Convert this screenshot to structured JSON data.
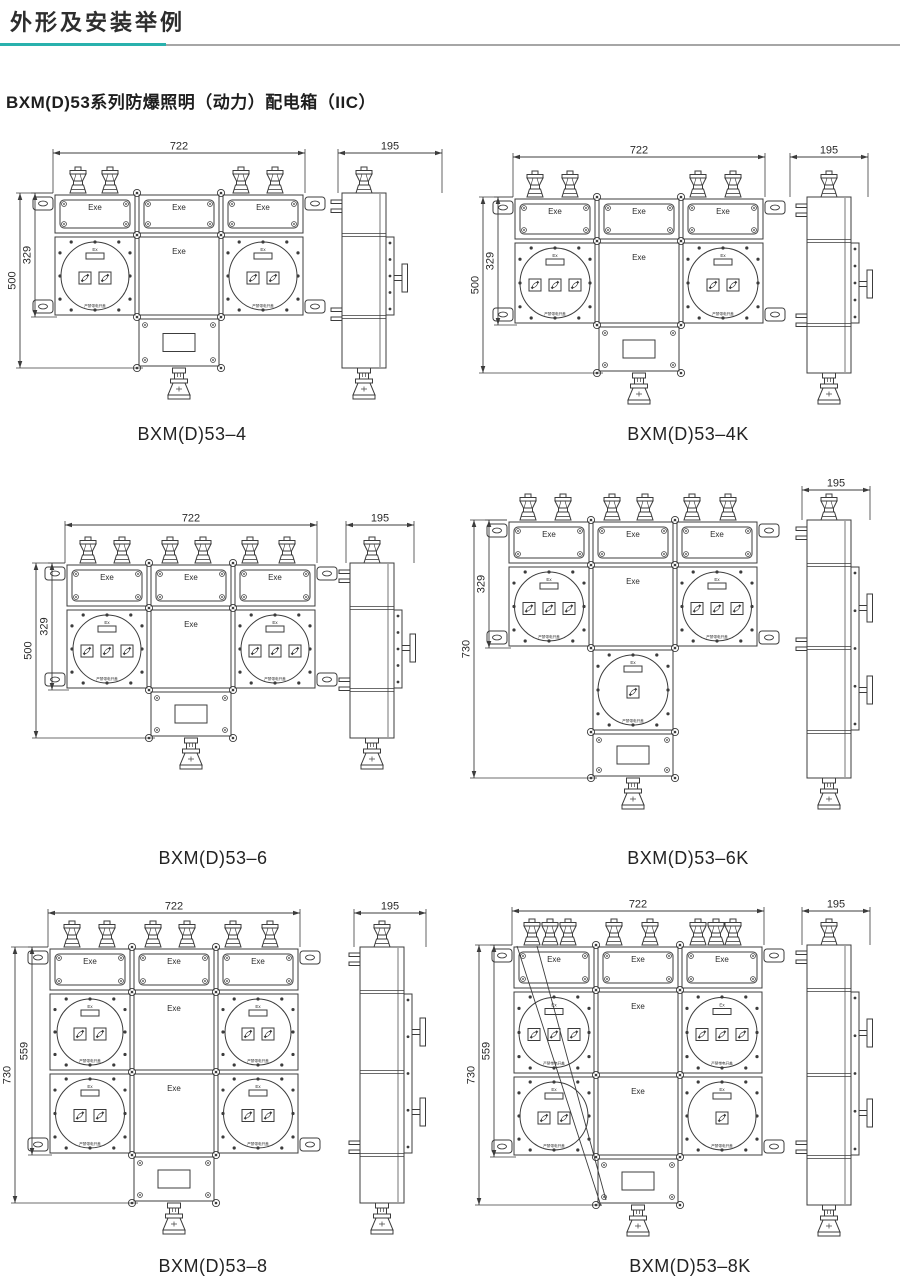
{
  "page": {
    "title": "外形及安装举例",
    "subtitle": "BXM(D)53系列防爆照明（动力）配电箱（IIC）",
    "accent_color": "#29b1ad",
    "rule_color": "#a6a6a6",
    "line_color": "#3c3c3c",
    "text_color": "#2a2a2a"
  },
  "shared_labels": {
    "exe": "Exe",
    "ex": "Ex",
    "warning": "严禁带电开盖"
  },
  "drawings": [
    {
      "label": "BXM(D)53–4",
      "dim_width": "722",
      "dim_side": "195",
      "dim_height_outer": "500",
      "dim_height_inner": "329",
      "top_cable_glands": 4,
      "switch_windows": [
        [
          2,
          2
        ]
      ],
      "has_diagonal_leader": false
    },
    {
      "label": "BXM(D)53–4K",
      "dim_width": "722",
      "dim_side": "195",
      "dim_height_outer": "500",
      "dim_height_inner": "329",
      "top_cable_glands": 4,
      "switch_windows": [
        [
          3,
          2
        ]
      ],
      "has_diagonal_leader": false
    },
    {
      "label": "BXM(D)53–6",
      "dim_width": "722",
      "dim_side": "195",
      "dim_height_outer": "500",
      "dim_height_inner": "329",
      "top_cable_glands": 6,
      "switch_windows": [
        [
          3,
          3
        ]
      ],
      "has_diagonal_leader": false
    },
    {
      "label": "BXM(D)53–6K",
      "dim_side": "195",
      "dim_height_outer": "730",
      "dim_height_inner": "329",
      "top_cable_glands": 6,
      "switch_windows": [
        [
          3,
          3
        ]
      ],
      "extra_center_switch_windows": 1,
      "has_diagonal_leader": false
    },
    {
      "label": "BXM(D)53–8",
      "dim_width": "722",
      "dim_side": "195",
      "dim_height_outer": "730",
      "dim_height_inner": "559",
      "top_cable_glands": 6,
      "switch_windows": [
        [
          2,
          2
        ],
        [
          2,
          2
        ]
      ],
      "has_diagonal_leader": false
    },
    {
      "label": "BXM(D)53–8K",
      "dim_width": "722",
      "dim_side": "195",
      "dim_height_outer": "730",
      "dim_height_inner": "559",
      "top_cable_glands": 8,
      "switch_windows": [
        [
          3,
          3
        ],
        [
          2,
          1
        ]
      ],
      "has_diagonal_leader": true
    }
  ]
}
